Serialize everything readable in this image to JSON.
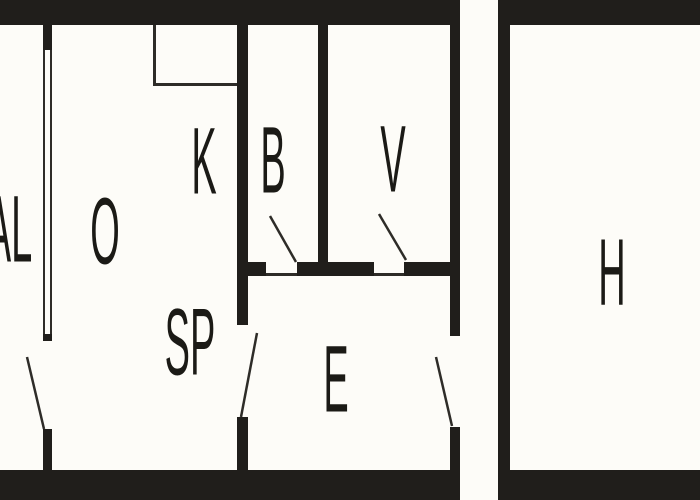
{
  "floorplan": {
    "colors": {
      "wall": "#201e1b",
      "line": "#2e2c28",
      "label": "#1b1a16",
      "background": "#fdfcf8"
    },
    "rooms": [
      {
        "id": "al",
        "label": "AL"
      },
      {
        "id": "o",
        "label": "O"
      },
      {
        "id": "k",
        "label": "K"
      },
      {
        "id": "b",
        "label": "B"
      },
      {
        "id": "v",
        "label": "V"
      },
      {
        "id": "sp",
        "label": "SP"
      },
      {
        "id": "e",
        "label": "E"
      },
      {
        "id": "h",
        "label": "H"
      }
    ],
    "doors": [
      {
        "id": "al-door"
      },
      {
        "id": "sp-e-door"
      },
      {
        "id": "b-door"
      },
      {
        "id": "v-door"
      },
      {
        "id": "e-exterior-door"
      }
    ]
  }
}
